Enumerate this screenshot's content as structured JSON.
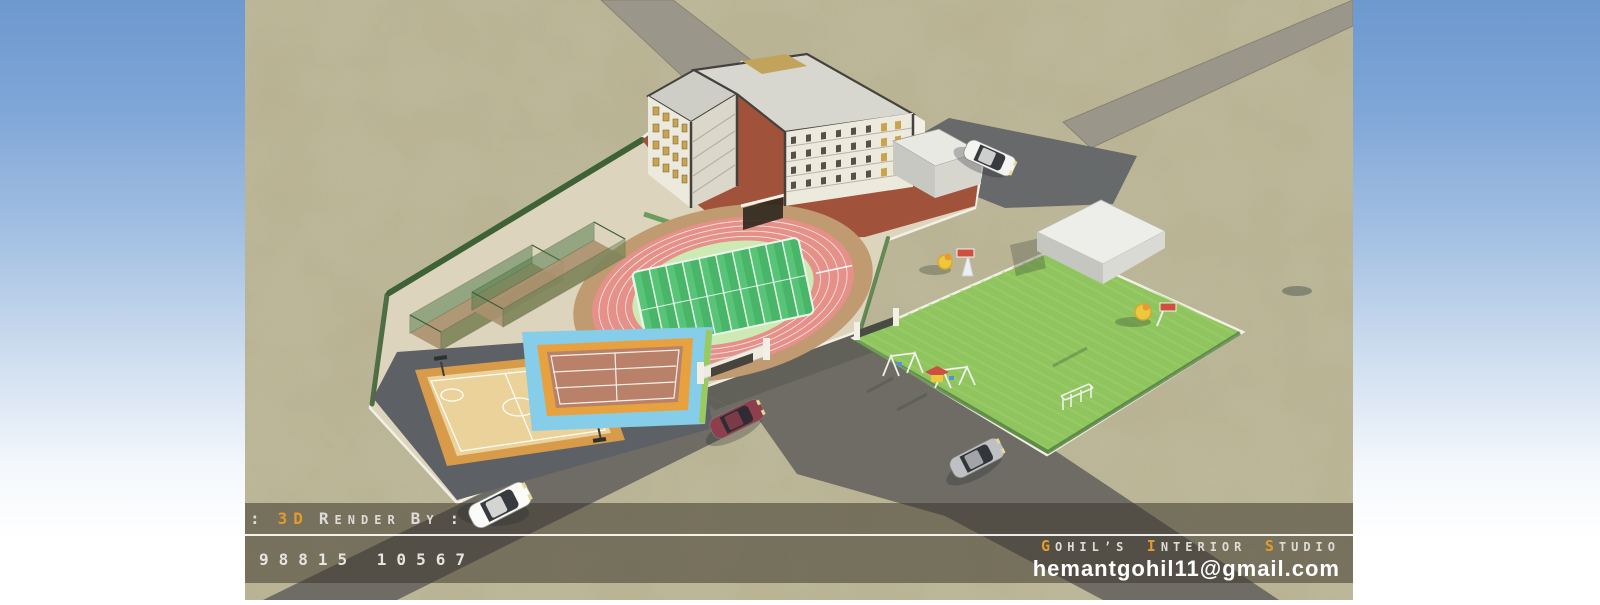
{
  "canvas": {
    "width": 1600,
    "height": 600
  },
  "backdrop": {
    "sky_top": "#6d99cf",
    "sky_mid": "#c3d6ec",
    "sky_bottom": "#ffffff"
  },
  "credits": {
    "accent_color": "#e39b2f",
    "render_by": {
      "prefix": ":",
      "highlight": "3D",
      "words": [
        {
          "head": "R",
          "rest": "ENDER"
        },
        {
          "head": "B",
          "rest": "Y"
        }
      ],
      "suffix": ":"
    },
    "phone": "98815 10567",
    "studio_words": [
      {
        "head": "G",
        "rest": "OHIL’S"
      },
      {
        "head": "I",
        "rest": "NTERIOR"
      },
      {
        "head": "S",
        "rest": "TUDIO"
      }
    ],
    "email": "hemantgohil11@gmail.com"
  },
  "scene": {
    "description": "Aerial 3D render of a school campus with five-storey building, running track, basketball and badminton courts, cricket practice nets and a childrens playground",
    "ground_color": "#b6b090",
    "road_color": "#6e6c64",
    "paver_road_color": "#9a968a",
    "campus_paving_color": "#ddd4bd",
    "courtyard_brick_color": "#a0523a",
    "boundary_wall_color": "#f2efe5",
    "hedge_color": "#3f6136",
    "building": {
      "label": "school building",
      "wall_color": "#ece9dd",
      "roof_color": "#d8d7cf",
      "trim_color": "#45423e",
      "window_gold": "#caa44c"
    },
    "track": {
      "outer_ring_color": "#c09a70",
      "lane_color": "#e59088",
      "lane_line_color": "#f7f3ee",
      "infield_ring_color": "#cde9b4",
      "field_green": "#49b569"
    },
    "basketball_court": {
      "border_color": "#d79b4a",
      "floor_color": "#ead29a",
      "apron_color": "#5d6165"
    },
    "badminton_court": {
      "apron_color": "#86cde9",
      "border_color": "#e8a13f",
      "floor_color": "#b9816a"
    },
    "playground": {
      "grass_color": "#8fc45f",
      "slide_yellow": "#edc83f",
      "equipment_red": "#cc4f3f",
      "equipment_blue": "#5b8fd4"
    },
    "shed_color": "#edede9",
    "cars": [
      {
        "label": "white sedan near building",
        "color": "#f4f4f1"
      },
      {
        "label": "maroon sedan on road",
        "color": "#8e3f4e"
      },
      {
        "label": "silver sedan on road",
        "color": "#bfc0c3"
      },
      {
        "label": "white sedan over credit bar",
        "color": "#fbfbf8"
      }
    ]
  }
}
